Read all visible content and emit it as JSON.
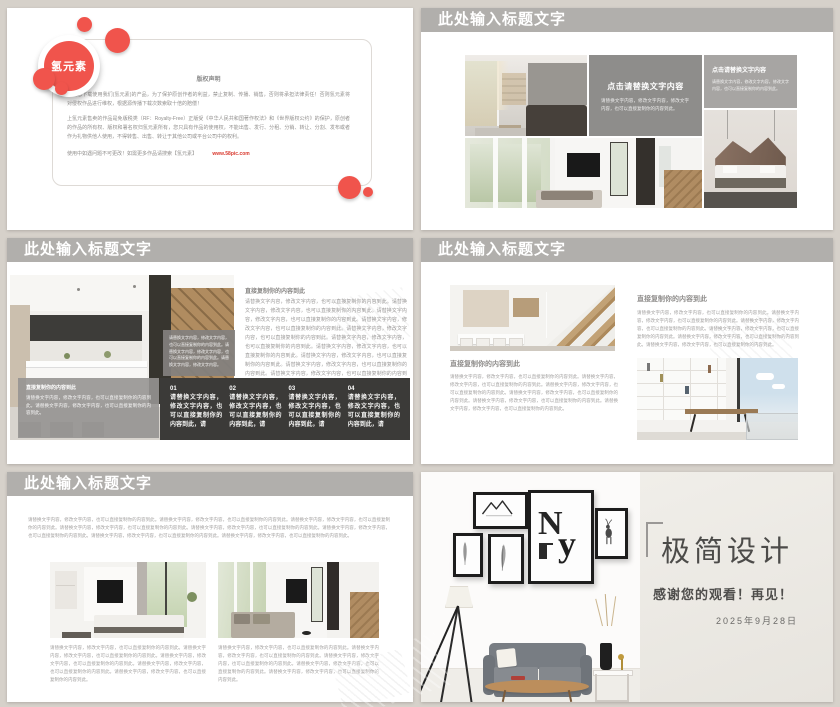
{
  "colors": {
    "accent_red": "#f0544c",
    "header_gray": "#b1afac",
    "dark_panel": "#3b3a38",
    "link_red": "#d93a2f"
  },
  "slides": {
    "slide1": {
      "logo_text": "氢元素",
      "title": "版权声明",
      "para1": "感谢您下载使用我们(氢元素)的产品，为了保护原创作者的利益，禁止复制、传播、销售，否则将承担法律责任！否则氢元素将对侵权作品进行维权，根据源传播下载次数索取十倍的赔偿！",
      "para2": "上氢元素售卖的作品是免版税类（RF：Royalty-Free）正版受《中华人民共和国著作权法》和《世界版权公约》的保护，原创者的作品的所有权、版权和署名权归氢元素所有，您只具有作品的使用权，不能出售、发行、分租、分销、转让、分割、发布或者作为礼物供他人使用，不得转售、出售、转让于其他公司或平台公司中的权利。",
      "para3": "使用中如遇问题不可更改！如需更多作品请搜索【氢元素】",
      "url": "www.58pic.com"
    },
    "slide2": {
      "title": "此处输入标题文字",
      "box1_title": "点击请替换文字内容",
      "box1_body": "请替换文字内容，修改文字内容，修改文字内容，也可以直接复制你的内容到此。",
      "box2_title": "点击请替换文字内容",
      "box2_body": "请替换文字内容，修改文字内容，修改文字内容，也可以直接复制你的内容到此。"
    },
    "slide3": {
      "title": "此处输入标题文字",
      "right_heading": "直接复制你的内容到此",
      "right_body": "请替换文字内容，修改文字内容，也可以直接复制你的内容到此。请替换文字内容，修改文字内容，也可以直接复制你的内容到此。请替换文字内容，修改文字内容，也可以直接复制你的内容到此。请替换文字内容，修改文字内容，也可以直接复制你的内容到此。请替换文字内容，修改文字内容，也可以直接复制你的内容到此。请替换文字内容，修改文字内容，也可以直接复制你的内容到此。请替换文字内容，修改文字内容，也可以直接复制你的内容到此。请替换文字内容，修改文字内容，也可以直接复制你的内容到此。请替换文字内容，修改文字内容，也可以直接复制你的内容到此。请替换文字内容，修改文字内容，也可以直接复制你的内容到此。",
      "photo_box_body": "请替换文字内容，修改文字内容，也可以直接复制你的内容到此。请替换文字内容，修改文字内容，也可以直接复制你的内容到此。请替换文字内容，修改文字内容。",
      "overlay_heading": "直接复制你的内容到此",
      "overlay_body": "请替换文字内容，修改文字内容，也可以直接复制你的内容到此。请替换文字内容，修改文字内容，也可以直接复制你的内容到此。",
      "steps": [
        {
          "num": "01",
          "text": "请替换文字内容，修改文字内容，也可以直接复制你的内容到此，请"
        },
        {
          "num": "02",
          "text": "请替换文字内容，修改文字内容，也可以直接复制你的内容到此，请"
        },
        {
          "num": "03",
          "text": "请替换文字内容，修改文字内容，也可以直接复制你的内容到此，请"
        },
        {
          "num": "04",
          "text": "请替换文字内容，修改文字内容，也可以直接复制你的内容到此，请"
        }
      ]
    },
    "slide4": {
      "title": "此处输入标题文字",
      "left_heading": "直接复制你的内容到此",
      "left_body": "请替换文字内容，修改文字内容，也可以直接复制你的内容到此。请替换文字内容，修改文字内容，也可以直接复制你的内容到此。请替换文字内容，修改文字内容，也可以直接复制你的内容到此。请替换文字内容，修改文字内容，也可以直接复制你的内容到此。请替换文字内容，修改文字内容，也可以直接复制你的内容到此。请替换文字内容，修改文字内容，也可以直接复制你的内容到此。",
      "right_heading": "直接复制你的内容到此",
      "right_body": "请替换文字内容，修改文字内容，也可以直接复制你的内容到此。请替换文字内容，修改文字内容，也可以直接复制你的内容到此。请替换文字内容，修改文字内容，也可以直接复制你的内容到此。请替换文字内容，修改文字内容，也可以直接复制你的内容到此。请替换文字内容，修改文字内容，也可以直接复制你的内容到此。请替换文字内容，修改文字内容，也可以直接复制你的内容到此。"
    },
    "slide5": {
      "title": "此处输入标题文字",
      "intro": "请替换文字内容，修改文字内容，也可以直接复制你的内容到此。请替换文字内容，修改文字内容，也可以直接复制你的内容到此。请替换文字内容，修改文字内容，也可以直接复制你的内容到此。请替换文字内容，修改文字内容，也可以直接复制你的内容到此。请替换文字内容，修改文字内容，也可以直接复制你的内容到此。请替换文字内容，修改文字内容，也可以直接复制你的内容到此。请替换文字内容，修改文字内容，也可以直接复制你的内容到此。请替换文字内容，修改文字内容，也可以直接复制你的内容到此。",
      "caption_left": "请替换文字内容，修改文字内容，也可以直接复制你的内容到此。请替换文字内容，修改文字内容，也可以直接复制你的内容到此。请替换文字内容，修改文字内容，也可以直接复制你的内容到此。请替换文字内容，修改文字内容，也可以直接复制你的内容到此。请替换文字内容，修改文字内容，也可以直接复制你的内容到此。",
      "caption_right": "请替换文字内容，修改文字内容，也可以直接复制你的内容到此。请替换文字内容，修改文字内容，也可以直接复制你的内容到此。请替换文字内容，修改文字内容，也可以直接复制你的内容到此。请替换文字内容，修改文字内容，也可以直接复制你的内容到此。请替换文字内容，修改文字内容，也可以直接复制你的内容到此。"
    },
    "slide6": {
      "frame_letter_n": "N",
      "frame_letter_y": "y",
      "title": "极简设计",
      "subtitle": "感谢您的观看！再见！",
      "date": "2025年9月28日"
    }
  }
}
